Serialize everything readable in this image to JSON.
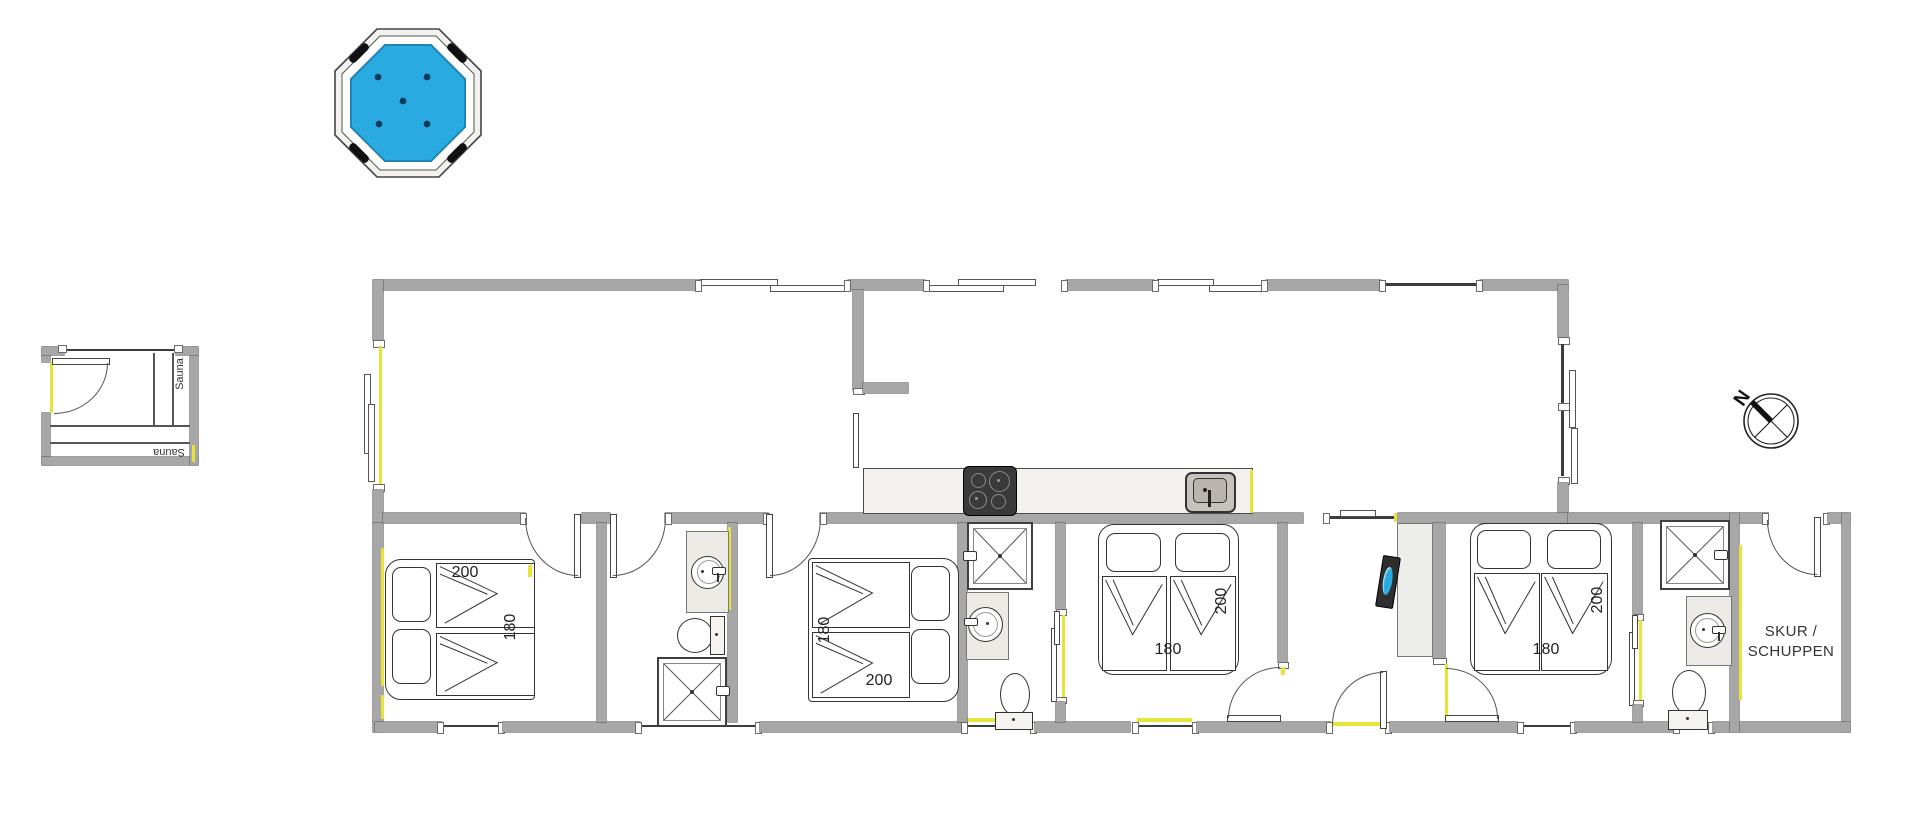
{
  "title": "holiday house floor plan",
  "colors": {
    "wall_gray": "#a7a7a7",
    "accent_yellow": "#e8e337",
    "hot_tub_water_blue": "#29abe2",
    "line_dark": "#3c3c3c",
    "counter_fill": "#f2f1ee"
  },
  "hot_tub": {
    "shape": "octagon",
    "jet_count": "5"
  },
  "sauna": {
    "side_label": "Sauna",
    "bench_label": "Sauna"
  },
  "bedrooms": [
    {
      "name": "bedroom-1",
      "bed_width": "200",
      "bed_length": "180"
    },
    {
      "name": "bedroom-2",
      "bed_width": "200",
      "bed_length": "180"
    },
    {
      "name": "bedroom-3",
      "bed_width": "200",
      "bed_length": "180"
    },
    {
      "name": "bedroom-4",
      "bed_width": "200",
      "bed_length": "180"
    }
  ],
  "kitchen": {
    "fixtures": [
      "cooktop",
      "sink"
    ]
  },
  "bathrooms": [
    {
      "name": "bathroom-1",
      "fixtures": [
        "washbasin",
        "toilet",
        "shower"
      ]
    },
    {
      "name": "bathroom-2",
      "fixtures": [
        "shower",
        "washbasin",
        "toilet"
      ]
    },
    {
      "name": "bathroom-3",
      "fixtures": [
        "shower",
        "washbasin",
        "toilet"
      ]
    }
  ],
  "shed": {
    "label_line1": "SKUR /",
    "label_line2": "SCHUPPEN"
  },
  "compass": {
    "north_label": "N"
  }
}
